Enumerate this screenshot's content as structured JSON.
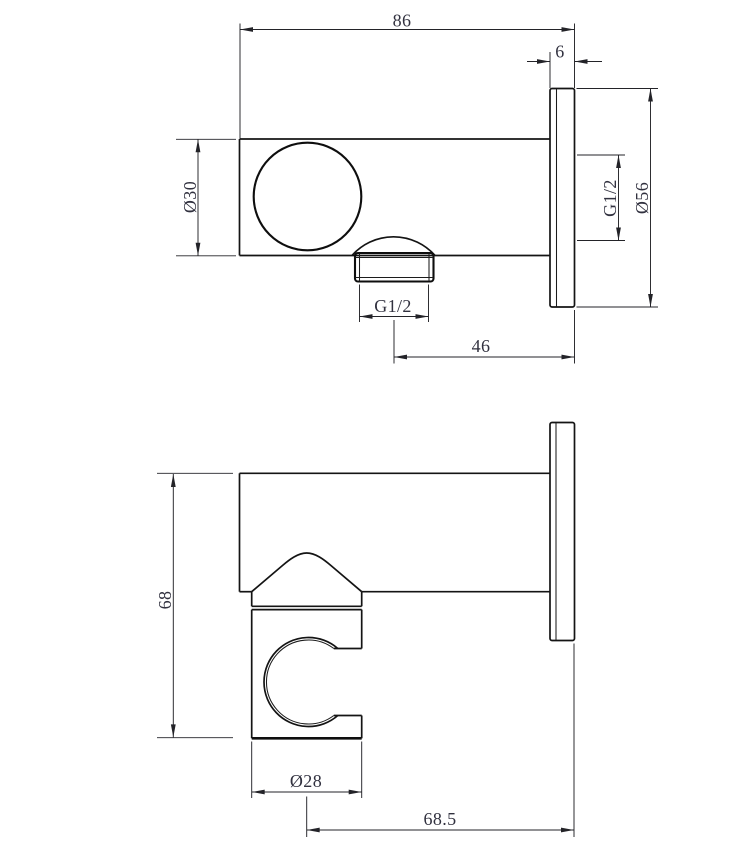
{
  "canvas": {
    "background": "#ffffff",
    "line_color": "#141414",
    "dim_line_color": "#232328",
    "dim_text_color": "#31313f"
  },
  "views": {
    "side": {
      "dims": {
        "total_depth": "86",
        "flange_thickness": "6",
        "body_diameter": "Ø30",
        "wall_thread": "G1/2",
        "flange_diameter": "Ø56",
        "outlet_thread": "G1/2",
        "outlet_to_wall": "46"
      }
    },
    "front": {
      "dims": {
        "total_height": "68",
        "holder_diameter": "Ø28",
        "holder_center_to_wall": "68.5"
      }
    }
  }
}
